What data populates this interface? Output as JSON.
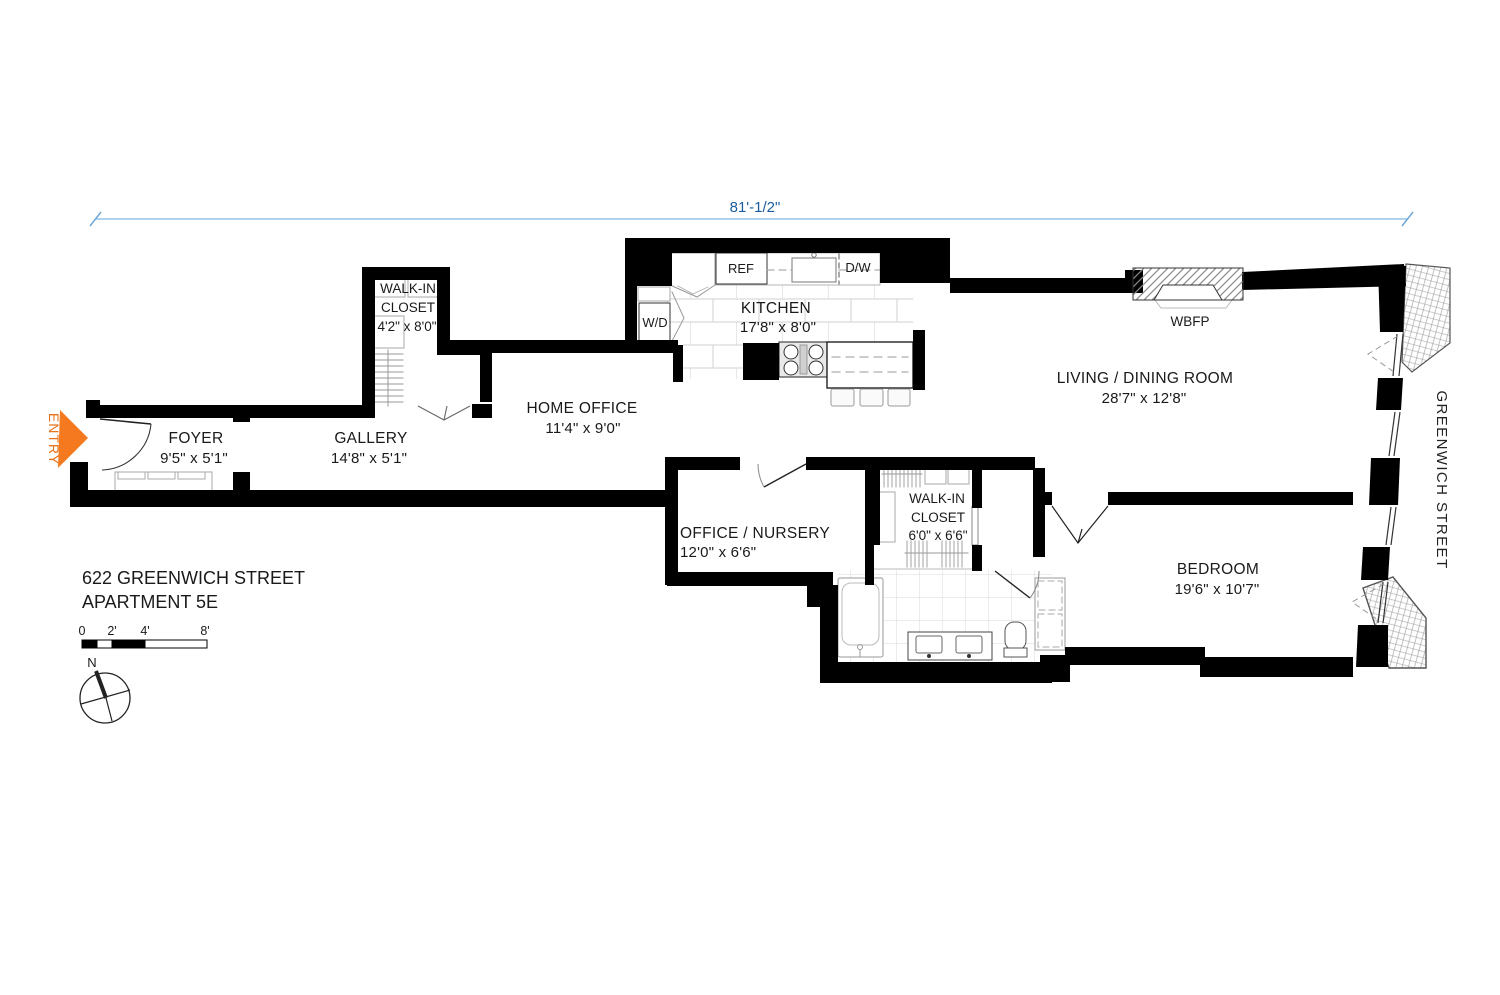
{
  "title": {
    "line1": "622 GREENWICH STREET",
    "line2": "APARTMENT 5E"
  },
  "dimension": {
    "width_label": "81'-1/2\""
  },
  "entry_label": "ENTRY",
  "street_label": "GREENWICH STREET",
  "compass_north": "N",
  "scale_bar": {
    "t0": "0",
    "t2": "2'",
    "t4": "4'",
    "t8": "8'"
  },
  "rooms": {
    "foyer": {
      "name": "FOYER",
      "dims": "9'5\" x 5'1\""
    },
    "gallery": {
      "name": "GALLERY",
      "dims": "14'8\" x 5'1\""
    },
    "closet_left": {
      "name1": "WALK-IN",
      "name2": "CLOSET",
      "dims": "4'2\" x 8'0\""
    },
    "home_office": {
      "name": "HOME OFFICE",
      "dims": "11'4\" x 9'0\""
    },
    "kitchen": {
      "name": "KITCHEN",
      "dims": "17'8\" x 8'0\""
    },
    "living": {
      "name": "LIVING / DINING ROOM",
      "dims": "28'7\" x 12'8\""
    },
    "office_nursery": {
      "name": "OFFICE / NURSERY",
      "dims": "12'0\" x 6'6\""
    },
    "closet_right": {
      "name1": "WALK-IN",
      "name2": "CLOSET",
      "dims": "6'0\" x 6'6\""
    },
    "bedroom": {
      "name": "BEDROOM",
      "dims": "19'6\" x 10'7\""
    }
  },
  "fixtures": {
    "ref": "REF",
    "dw": "D/W",
    "wd": "W/D",
    "wbfp": "WBFP"
  },
  "colors": {
    "accent_orange": "#F4791F",
    "dim_text_blue": "#1B5C9E",
    "dim_line_blue": "#AFD3EF"
  }
}
